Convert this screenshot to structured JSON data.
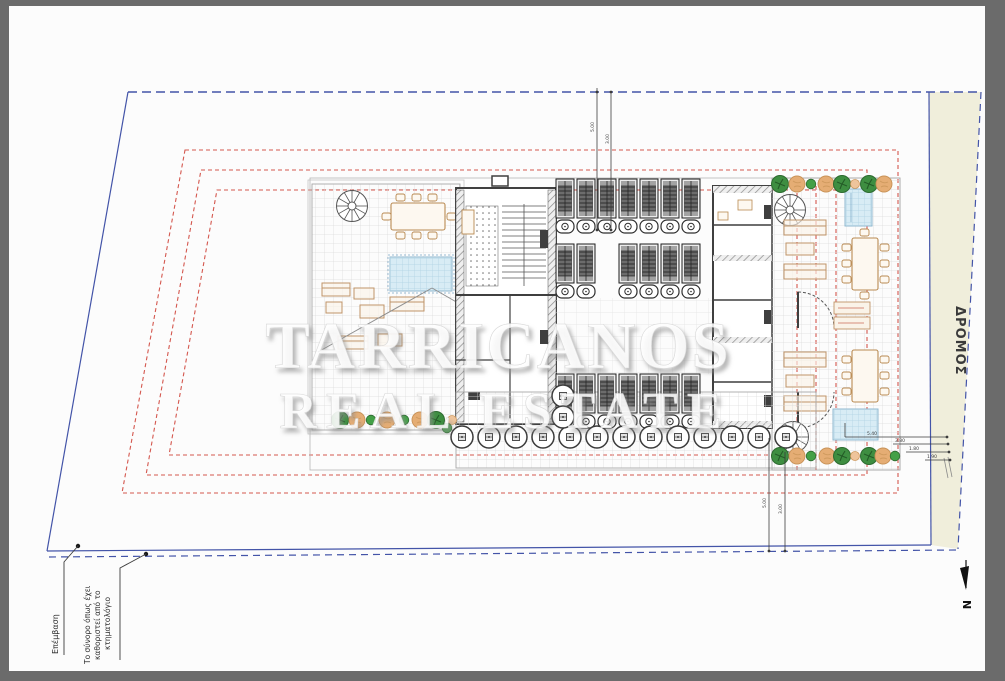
{
  "drawing": {
    "road_label": "ΔΡΟΜΟΣ",
    "north_label": "N",
    "annotations": {
      "intervention": "Επέμβαση",
      "cadastre_note": [
        "Το σύνορο όπως έχει",
        "καθοριστεί από το",
        "κτηματολόγιο"
      ]
    },
    "watermark": {
      "line1": "TARRICANOS",
      "line2": "REAL ESTATE"
    },
    "dimensions": {
      "top": [
        "5.00",
        "3.00"
      ],
      "bottom": [
        "5.00",
        "3.00"
      ],
      "right": [
        "5.40",
        "3.80",
        "1.80",
        "1.90"
      ]
    },
    "colors": {
      "frame": "#6b6b6b",
      "boundary_blue": "#4354a8",
      "setback_red": "#d4574e",
      "road_fill": "#f0eedb",
      "pool": "#d8ecf5",
      "tree_green": "#3e8e41",
      "tree_tan": "#e5ad74"
    }
  }
}
